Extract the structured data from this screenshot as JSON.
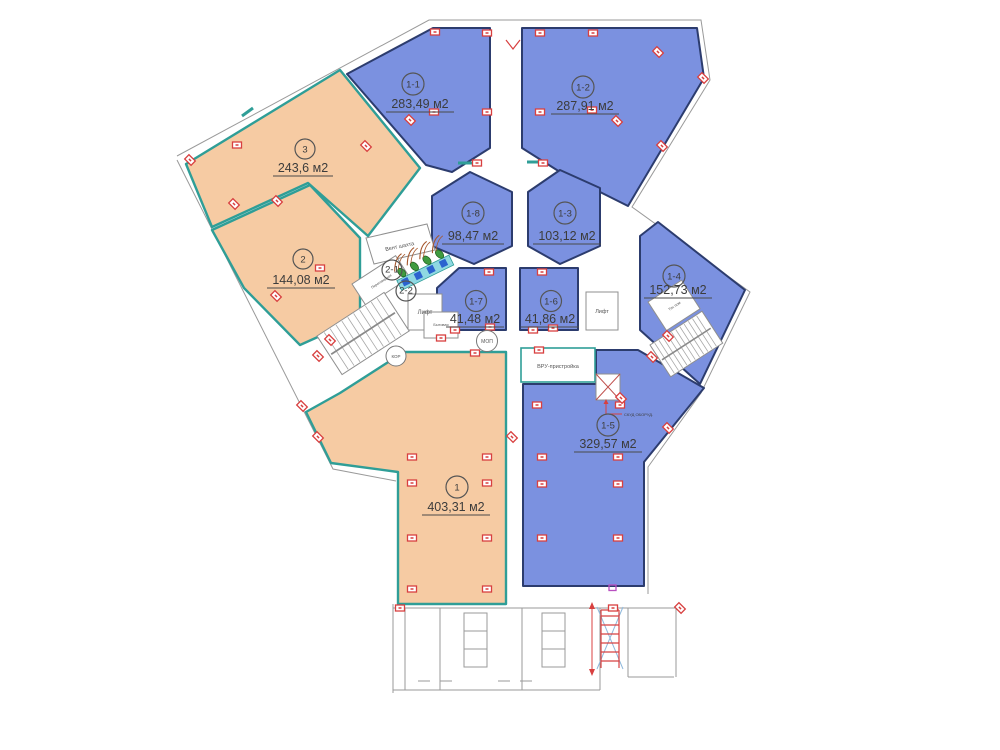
{
  "plan": {
    "rooms": {
      "r11": {
        "number": "1-1",
        "area": "283,49 м2"
      },
      "r12": {
        "number": "1-2",
        "area": "287,91 м2"
      },
      "r3": {
        "number": "3",
        "area": "243,6 м2"
      },
      "r2": {
        "number": "2",
        "area": "144,08 м2"
      },
      "r18": {
        "number": "1-8",
        "area": "98,47 м2"
      },
      "r13": {
        "number": "1-3",
        "area": "103,12 м2"
      },
      "r14": {
        "number": "1-4",
        "area": "152,73 м2"
      },
      "r17": {
        "number": "1-7",
        "area": "41,48 м2"
      },
      "r16": {
        "number": "1-6",
        "area": "41,86 м2"
      },
      "r15": {
        "number": "1-5",
        "area": "329,57 м2"
      },
      "r1": {
        "number": "1",
        "area": "403,31 м2"
      },
      "s21": {
        "number": "2-1"
      },
      "s22": {
        "number": "2-2"
      }
    },
    "labels": {
      "vent_shaft": "Вент шахта",
      "lift_left": "Лифт",
      "lift_right": "Лифт",
      "mop": "МОП",
      "kor": "КОР",
      "vru": "ВРУ-пристройка",
      "tech_room": "Тех пом",
      "utility": "Бытовая",
      "meeting": "Переговорная",
      "skud": "СКУД ОБОРУД."
    },
    "colors": {
      "office_blue": "#7b91e0",
      "office_orange": "#f6cba3",
      "wall_teal": "#2f9e97",
      "wall_navy": "#2c3c6e",
      "marker_red": "#d84040"
    }
  }
}
